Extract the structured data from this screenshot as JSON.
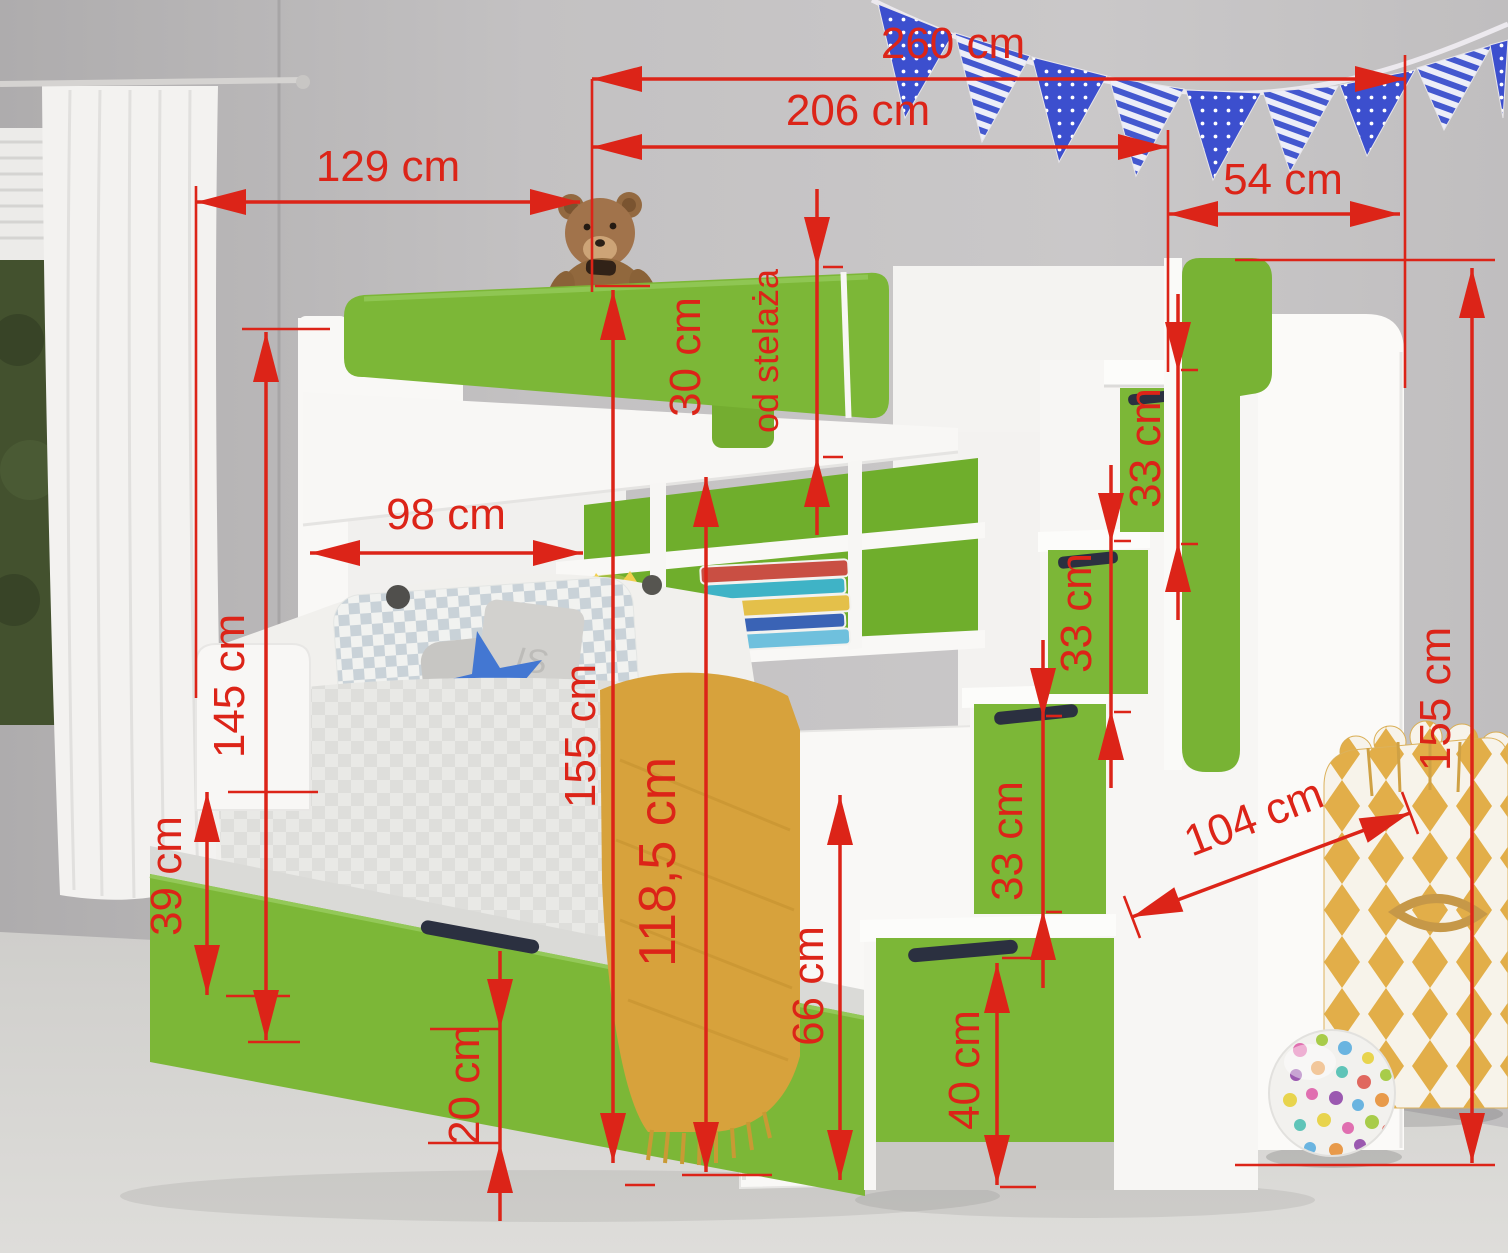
{
  "meta": {
    "title": "Bunk bed with stairs and trundle - dimension diagram",
    "scene_description": "White and green children's bunk bed with lower bed, trundle drawer, bookshelf, stair drawers and handrail, in a bedroom with white curtain, blue pennant bunting, teddy bear, yellow storage bag and polka-dot ball"
  },
  "annotation": {
    "color": "#dc2418",
    "font_size": 44,
    "line_width": 3.5,
    "ext_line_width": 2.6,
    "arrow_length": 50,
    "arrow_half_width": 13
  },
  "scene": {
    "pillow_text": "IS",
    "colors": {
      "green": "#7cb737",
      "green_dark": "#6fae2c",
      "white_furniture": "#f8f7f5",
      "wall": "#c3c1c2",
      "carpet": "#d7d6d3",
      "bunting_blue": "#3c4fce",
      "blanket": "#d7a23c",
      "bag_yellow": "#e2ae49",
      "handle_slot": "#2b3040"
    }
  },
  "dimensions": [
    {
      "id": "total-width",
      "label": "260 cm",
      "x1": 592,
      "y1": 79,
      "x2": 1405,
      "y2": 79,
      "style": "in",
      "lx": 953,
      "ly": 44,
      "rot": 0
    },
    {
      "id": "bed-width",
      "label": "206 cm",
      "x1": 592,
      "y1": 147,
      "x2": 1168,
      "y2": 147,
      "style": "in",
      "lx": 858,
      "ly": 111,
      "rot": 0
    },
    {
      "id": "front-width",
      "label": "129 cm",
      "x1": 196,
      "y1": 202,
      "x2": 580,
      "y2": 202,
      "style": "in",
      "lx": 388,
      "ly": 167,
      "rot": 0
    },
    {
      "id": "stairs-width",
      "label": "54 cm",
      "x1": 1168,
      "y1": 214,
      "x2": 1400,
      "y2": 214,
      "style": "in",
      "lx": 1283,
      "ly": 180,
      "rot": 0
    },
    {
      "id": "rail-height",
      "label": "30 cm",
      "label2": "od stelaża",
      "x1": 817,
      "y1": 267,
      "x2": 817,
      "y2": 457,
      "style": "out",
      "lx": 686,
      "ly": 357,
      "rot": -90,
      "l2x": 766,
      "l2y": 351,
      "fs2": 36
    },
    {
      "id": "alcove-width",
      "label": "98 cm",
      "x1": 310,
      "y1": 553,
      "x2": 583,
      "y2": 553,
      "style": "in",
      "lx": 446,
      "ly": 515,
      "rot": 0
    },
    {
      "id": "step-height-top",
      "label": "33 cm",
      "x1": 1178,
      "y1": 372,
      "x2": 1178,
      "y2": 542,
      "style": "out",
      "lx": 1146,
      "ly": 448,
      "rot": -90
    },
    {
      "id": "step-height-mid",
      "label": "33 cm",
      "x1": 1111,
      "y1": 543,
      "x2": 1111,
      "y2": 710,
      "style": "out",
      "lx": 1077,
      "ly": 613,
      "rot": -90
    },
    {
      "id": "step-height-low",
      "label": "33 cm",
      "x1": 1043,
      "y1": 718,
      "x2": 1043,
      "y2": 910,
      "style": "out",
      "lx": 1008,
      "ly": 841,
      "rot": -90
    },
    {
      "id": "headboard-height",
      "label": "145 cm",
      "x1": 266,
      "y1": 332,
      "x2": 266,
      "y2": 1040,
      "style": "in",
      "lx": 230,
      "ly": 686,
      "rot": -90
    },
    {
      "id": "bed-height",
      "label": "155 cm",
      "x1": 613,
      "y1": 290,
      "x2": 613,
      "y2": 1163,
      "style": "in",
      "lx": 581,
      "ly": 736,
      "rot": -90
    },
    {
      "id": "under-bunk-height",
      "label": "118,5 cm",
      "x1": 706,
      "y1": 477,
      "x2": 706,
      "y2": 1172,
      "style": "in",
      "lx": 658,
      "ly": 862,
      "rot": -90,
      "fs": 52
    },
    {
      "id": "stairs-height",
      "label": "155 cm",
      "x1": 1472,
      "y1": 268,
      "x2": 1472,
      "y2": 1163,
      "style": "in",
      "lx": 1436,
      "ly": 699,
      "rot": -90
    },
    {
      "id": "stairs-depth",
      "label": "104 cm",
      "x1": 1132,
      "y1": 917,
      "x2": 1410,
      "y2": 813,
      "style": "in",
      "lx": 1254,
      "ly": 818,
      "rot": -21
    },
    {
      "id": "trundle-height",
      "label": "39 cm",
      "x1": 207,
      "y1": 792,
      "x2": 207,
      "y2": 995,
      "style": "in",
      "lx": 167,
      "ly": 876,
      "rot": -90
    },
    {
      "id": "footboard-height",
      "label": "66 cm",
      "x1": 840,
      "y1": 795,
      "x2": 840,
      "y2": 1180,
      "style": "in",
      "lx": 809,
      "ly": 986,
      "rot": -90
    },
    {
      "id": "clearance-height",
      "label": "20 cm",
      "x1": 500,
      "y1": 1029,
      "x2": 500,
      "y2": 1143,
      "style": "out",
      "lx": 465,
      "ly": 1085,
      "rot": -90
    },
    {
      "id": "drawer-height",
      "label": "40 cm",
      "x1": 997,
      "y1": 963,
      "x2": 997,
      "y2": 1185,
      "style": "in",
      "lx": 965,
      "ly": 1070,
      "rot": -90
    }
  ],
  "extension_lines": [
    [
      592,
      79,
      592,
      292
    ],
    [
      196,
      186,
      196,
      698
    ],
    [
      1405,
      55,
      1405,
      388
    ],
    [
      1168,
      130,
      1168,
      372
    ],
    [
      1235,
      260,
      1495,
      260
    ],
    [
      1235,
      1165,
      1495,
      1165
    ],
    [
      242,
      329,
      330,
      329
    ],
    [
      248,
      1042,
      300,
      1042
    ],
    [
      228,
      792,
      318,
      792
    ],
    [
      226,
      996,
      290,
      996
    ],
    [
      430,
      1029,
      500,
      1029
    ],
    [
      428,
      1143,
      500,
      1143
    ],
    [
      595,
      286,
      650,
      286
    ],
    [
      625,
      1185,
      655,
      1185
    ],
    [
      682,
      1175,
      772,
      1175
    ],
    [
      1002,
      958,
      1038,
      958
    ],
    [
      1000,
      1187,
      1036,
      1187
    ],
    [
      823,
      267,
      843,
      267
    ],
    [
      823,
      457,
      843,
      457
    ],
    [
      1181,
      370,
      1198,
      370
    ],
    [
      1181,
      544,
      1198,
      544
    ],
    [
      1114,
      541,
      1131,
      541
    ],
    [
      1114,
      712,
      1131,
      712
    ],
    [
      1046,
      716,
      1062,
      716
    ],
    [
      1046,
      912,
      1062,
      912
    ],
    [
      1124,
      896,
      1140,
      938
    ],
    [
      1402,
      792,
      1418,
      834
    ]
  ]
}
